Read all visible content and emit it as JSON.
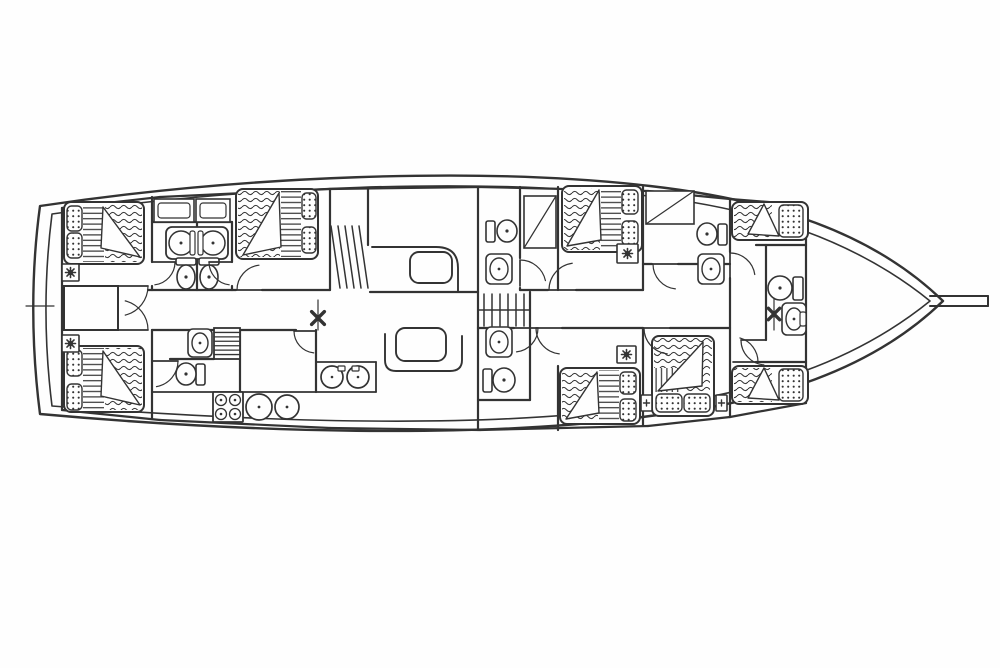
{
  "meta": {
    "type": "boat-deck-plan",
    "description": "Black-line accommodation / layout plan of a gulet style sailing yacht, bow to the right with bowsprit, six double-bed guest cabins, two bow crew berths, bathrooms with toilets and washbasins, central saloon with settees and tables, galley with stove and sinks, companionway stairs, two mast positions"
  },
  "canvas": {
    "width": 1000,
    "height": 668,
    "background": "#fefefe",
    "ink": "#333333"
  },
  "hull": {
    "outer": "M 40,206 C 240,176 480,166 650,186 C 772,200 872,232 943,301 C 872,370 772,402 650,416 C 480,440 240,432 40,414 C 31,344 31,272 40,206 Z",
    "inner": "M 52,214 C 246,186 480,177 648,196 C 762,209 856,241 930,301 C 856,361 762,393 648,406 C 480,431 246,421 52,406 C 44,342 44,277 52,214 Z",
    "bowsprit": [
      [
        930,
        296,
        988,
        296
      ],
      [
        930,
        306,
        988,
        306
      ],
      [
        988,
        296,
        988,
        306
      ]
    ],
    "stern_tick": [
      26,
      306,
      54,
      306
    ]
  },
  "walls": [
    [
      62,
      208,
      62,
      410
    ],
    [
      806,
      205,
      806,
      403
    ],
    [
      62,
      208,
      160,
      197
    ],
    [
      160,
      197,
      330,
      189
    ],
    [
      330,
      189,
      480,
      187
    ],
    [
      480,
      187,
      648,
      191
    ],
    [
      648,
      191,
      730,
      199
    ],
    [
      730,
      199,
      806,
      205
    ],
    [
      62,
      410,
      160,
      420
    ],
    [
      160,
      420,
      330,
      428
    ],
    [
      330,
      428,
      480,
      430
    ],
    [
      480,
      430,
      648,
      426
    ],
    [
      648,
      426,
      730,
      417
    ],
    [
      730,
      417,
      806,
      403
    ],
    [
      152,
      197,
      152,
      262
    ],
    [
      152,
      286,
      152,
      290
    ],
    [
      152,
      330,
      152,
      419
    ],
    [
      152,
      222,
      232,
      222
    ],
    [
      197,
      222,
      197,
      290
    ],
    [
      232,
      222,
      232,
      262
    ],
    [
      232,
      286,
      232,
      290
    ],
    [
      148,
      290,
      236,
      290
    ],
    [
      262,
      290,
      330,
      290
    ],
    [
      370,
      292,
      478,
      292
    ],
    [
      152,
      330,
      296,
      330
    ],
    [
      316,
      330,
      316,
      392
    ],
    [
      330,
      189,
      330,
      290
    ],
    [
      368,
      189,
      368,
      245
    ],
    [
      478,
      187,
      478,
      292
    ],
    [
      478,
      292,
      478,
      328
    ],
    [
      478,
      328,
      478,
      430
    ],
    [
      520,
      187,
      520,
      258
    ],
    [
      520,
      288,
      520,
      290
    ],
    [
      558,
      187,
      558,
      290
    ],
    [
      520,
      290,
      548,
      290
    ],
    [
      576,
      290,
      643,
      290
    ],
    [
      530,
      292,
      530,
      328
    ],
    [
      478,
      328,
      514,
      328
    ],
    [
      562,
      328,
      643,
      328
    ],
    [
      670,
      328,
      730,
      328
    ],
    [
      530,
      328,
      530,
      400
    ],
    [
      478,
      400,
      530,
      400
    ],
    [
      558,
      366,
      558,
      430
    ],
    [
      643,
      187,
      643,
      290
    ],
    [
      643,
      328,
      643,
      425
    ],
    [
      643,
      264,
      652,
      264
    ],
    [
      678,
      264,
      730,
      264
    ],
    [
      730,
      199,
      730,
      252
    ],
    [
      730,
      278,
      730,
      417
    ],
    [
      756,
      245,
      806,
      245
    ],
    [
      756,
      362,
      806,
      362
    ],
    [
      766,
      245,
      766,
      340
    ],
    [
      170,
      359,
      214,
      359
    ],
    [
      240,
      330,
      240,
      392
    ]
  ],
  "hatch": {
    "rect": [
      64,
      286,
      54,
      44
    ]
  },
  "galley_lines": [
    [
      152,
      392,
      316,
      392
    ],
    [
      316,
      362,
      376,
      362
    ],
    [
      376,
      362,
      376,
      392
    ],
    [
      316,
      392,
      376,
      392
    ]
  ],
  "stairs": [
    {
      "name": "stairs-forward",
      "lines": [
        [
          331,
          226,
          340,
          288
        ],
        [
          338,
          226,
          347,
          288
        ],
        [
          345,
          226,
          354,
          288
        ],
        [
          352,
          226,
          361,
          288
        ],
        [
          359,
          226,
          368,
          288
        ]
      ]
    },
    {
      "name": "companionway-steps",
      "lines": [
        [
          484,
          294,
          484,
          326
        ],
        [
          492,
          294,
          492,
          326
        ],
        [
          500,
          294,
          500,
          326
        ],
        [
          508,
          294,
          508,
          326
        ],
        [
          516,
          294,
          516,
          326
        ],
        [
          524,
          294,
          524,
          326
        ],
        [
          478,
          310,
          530,
          310
        ]
      ]
    }
  ],
  "ladder": {
    "rect": [
      214,
      328,
      26,
      31
    ],
    "rungs": 6
  },
  "settees": [
    "M 372,247 L 436,247 Q 458,247 458,268 L 458,292",
    "M 385,334 L 385,360 Q 385,371 396,371 L 450,371 Q 462,371 462,360 L 462,336"
  ],
  "tables": [
    [
      410,
      252,
      42,
      31
    ],
    [
      396,
      328,
      50,
      33
    ]
  ],
  "cabinets": [
    {
      "rect": [
        154,
        199,
        40,
        23
      ],
      "inner": [
        158,
        203,
        32,
        15
      ]
    },
    {
      "rect": [
        196,
        199,
        34,
        23
      ],
      "inner": [
        200,
        203,
        26,
        15
      ]
    },
    {
      "rect": [
        524,
        196,
        32,
        52
      ],
      "diag": [
        524,
        248,
        556,
        196
      ]
    },
    {
      "rect": [
        646,
        191,
        48,
        33
      ],
      "diag": [
        646,
        224,
        694,
        191
      ]
    }
  ],
  "beds": [
    {
      "outline": [
        64,
        202,
        80,
        62
      ],
      "waves": [
        [
          105,
          204,
          37,
          58
        ]
      ],
      "stripes": [
        [
          83,
          204,
          21,
          58,
          "h"
        ]
      ],
      "pillows": [
        [
          67,
          206,
          15,
          25
        ],
        [
          67,
          233,
          15,
          25
        ]
      ],
      "fold": [
        [
          103,
          207
        ],
        [
          140,
          257
        ],
        [
          101,
          248
        ]
      ]
    },
    {
      "outline": [
        64,
        346,
        80,
        66
      ],
      "waves": [
        [
          105,
          348,
          37,
          62
        ]
      ],
      "stripes": [
        [
          83,
          348,
          21,
          62,
          "h"
        ]
      ],
      "pillows": [
        [
          67,
          350,
          15,
          26
        ],
        [
          67,
          384,
          15,
          26
        ]
      ],
      "fold": [
        [
          103,
          351
        ],
        [
          140,
          405
        ],
        [
          101,
          396
        ]
      ]
    },
    {
      "outline": [
        236,
        189,
        82,
        70
      ],
      "waves": [
        [
          238,
          191,
          42,
          66
        ]
      ],
      "stripes": [
        [
          281,
          191,
          20,
          66,
          "h"
        ]
      ],
      "pillows": [
        [
          302,
          193,
          14,
          26
        ],
        [
          302,
          227,
          14,
          26
        ]
      ],
      "fold": [
        [
          279,
          193
        ],
        [
          243,
          255
        ],
        [
          281,
          247
        ]
      ]
    },
    {
      "outline": [
        562,
        186,
        80,
        66
      ],
      "waves": [
        [
          564,
          188,
          36,
          62
        ]
      ],
      "stripes": [
        [
          601,
          188,
          20,
          62,
          "h"
        ]
      ],
      "pillows": [
        [
          622,
          190,
          16,
          24
        ],
        [
          622,
          221,
          16,
          24
        ]
      ],
      "fold": [
        [
          599,
          190
        ],
        [
          567,
          246
        ],
        [
          601,
          240
        ]
      ]
    },
    {
      "outline": [
        560,
        368,
        80,
        56
      ],
      "waves": [
        [
          562,
          370,
          36,
          52
        ]
      ],
      "stripes": [
        [
          599,
          370,
          20,
          52,
          "h"
        ]
      ],
      "pillows": [
        [
          620,
          372,
          16,
          22
        ],
        [
          620,
          399,
          16,
          22
        ]
      ],
      "fold": [
        [
          597,
          372
        ],
        [
          566,
          419
        ],
        [
          599,
          413
        ]
      ]
    },
    {
      "outline": [
        652,
        336,
        62,
        80
      ],
      "waves": [
        [
          654,
          338,
          58,
          30
        ],
        [
          684,
          368,
          26,
          24
        ]
      ],
      "stripes": [
        [
          655,
          368,
          27,
          24,
          "v"
        ]
      ],
      "pillows": [
        [
          656,
          394,
          26,
          18
        ],
        [
          684,
          394,
          26,
          18
        ]
      ],
      "fold": [
        [
          703,
          342
        ],
        [
          658,
          391
        ],
        [
          702,
          386
        ]
      ]
    },
    {
      "outline": [
        732,
        202,
        76,
        38
      ],
      "waves": [
        [
          734,
          204,
          38,
          34
        ]
      ],
      "stripes": [],
      "pillows": [
        [
          779,
          205,
          24,
          32
        ]
      ],
      "fold": [
        [
          764,
          204
        ],
        [
          779,
          236
        ],
        [
          748,
          234
        ]
      ]
    },
    {
      "outline": [
        732,
        366,
        76,
        38
      ],
      "waves": [
        [
          734,
          368,
          38,
          34
        ]
      ],
      "stripes": [],
      "pillows": [
        [
          779,
          369,
          24,
          32
        ]
      ],
      "fold": [
        [
          764,
          368
        ],
        [
          779,
          400
        ],
        [
          748,
          398
        ]
      ]
    }
  ],
  "vanity": {
    "box": [
      166,
      227,
      62,
      32
    ],
    "bowls": [
      [
        181,
        243,
        12,
        12
      ],
      [
        213,
        243,
        12,
        12
      ]
    ],
    "dividers": [
      [
        190,
        231,
        5,
        24
      ],
      [
        198,
        231,
        5,
        24
      ]
    ]
  },
  "toilets": [
    {
      "tank": [
        176,
        258,
        20,
        7
      ],
      "bowl": [
        186,
        277,
        9,
        12
      ]
    },
    {
      "tank": [
        199,
        258,
        20,
        7
      ],
      "bowl": [
        209,
        277,
        9,
        12
      ]
    },
    {
      "tank": [
        486,
        221,
        9,
        21
      ],
      "bowl": [
        507,
        231,
        10,
        11
      ]
    },
    {
      "tank": [
        483,
        369,
        9,
        23
      ],
      "bowl": [
        504,
        380,
        11,
        12
      ]
    },
    {
      "tank": [
        196,
        364,
        9,
        21
      ],
      "bowl": [
        186,
        374,
        10,
        11
      ]
    },
    {
      "tank": [
        718,
        224,
        9,
        21
      ],
      "bowl": [
        707,
        234,
        10,
        11
      ]
    },
    {
      "tank": [
        793,
        277,
        10,
        23
      ],
      "bowl": [
        780,
        288,
        12,
        12
      ]
    }
  ],
  "sinks": [
    {
      "box": [
        188,
        329,
        24,
        28
      ],
      "bowl": [
        200,
        343,
        8,
        10
      ]
    },
    {
      "box": [
        486,
        254,
        26,
        30
      ],
      "bowl": [
        499,
        269,
        9,
        11
      ]
    },
    {
      "box": [
        486,
        327,
        26,
        30
      ],
      "bowl": [
        499,
        342,
        9,
        11
      ]
    },
    {
      "box": [
        698,
        254,
        26,
        30
      ],
      "bowl": [
        711,
        269,
        9,
        11
      ]
    },
    {
      "box": [
        782,
        303,
        24,
        32
      ],
      "bowl": [
        794,
        319,
        8,
        11
      ],
      "tap": [
        800,
        312,
        6,
        14
      ]
    }
  ],
  "corner_units": [
    {
      "box": [
        62,
        264,
        17,
        17
      ],
      "glyph": "fan"
    },
    {
      "box": [
        62,
        335,
        17,
        17
      ],
      "glyph": "fan"
    },
    {
      "box": [
        617,
        244,
        21,
        19
      ],
      "glyph": "fan"
    },
    {
      "box": [
        617,
        346,
        19,
        17
      ],
      "glyph": "fan"
    },
    {
      "box": [
        641,
        395,
        11,
        16
      ],
      "glyph": "plus"
    },
    {
      "box": [
        716,
        395,
        11,
        16
      ],
      "glyph": "plus"
    }
  ],
  "stove": {
    "rect": [
      213,
      392,
      30,
      30
    ],
    "burners": [
      [
        221,
        400
      ],
      [
        235,
        400
      ],
      [
        221,
        414
      ],
      [
        235,
        414
      ]
    ],
    "burner_r": 5.5
  },
  "pots": [
    [
      259,
      407,
      13
    ],
    [
      287,
      407,
      12
    ]
  ],
  "island": {
    "circles": [
      [
        332,
        377,
        11
      ],
      [
        358,
        377,
        11
      ]
    ],
    "taps": [
      [
        338,
        366,
        7,
        5
      ],
      [
        352,
        366,
        7,
        5
      ]
    ]
  },
  "doors": [
    {
      "h": [
        118,
        286
      ],
      "r": 30,
      "a0": 0,
      "a1": 76
    },
    {
      "h": [
        118,
        330
      ],
      "r": 30,
      "a0": 0,
      "a1": -76
    },
    {
      "h": [
        152,
        262
      ],
      "r": 23,
      "a0": 0,
      "a1": 83
    },
    {
      "h": [
        232,
        262
      ],
      "r": 23,
      "a0": 180,
      "a1": 97
    },
    {
      "h": [
        262,
        290
      ],
      "r": 25,
      "a0": 180,
      "a1": 263
    },
    {
      "h": [
        316,
        331
      ],
      "r": 22,
      "a0": 180,
      "a1": 96
    },
    {
      "h": [
        152,
        361
      ],
      "r": 26,
      "a0": 0,
      "a1": 80
    },
    {
      "h": [
        520,
        286
      ],
      "r": 26,
      "a0": 270,
      "a1": 348
    },
    {
      "h": [
        576,
        290
      ],
      "r": 27,
      "a0": 180,
      "a1": 262
    },
    {
      "h": [
        514,
        328
      ],
      "r": 24,
      "a0": 0,
      "a1": 84
    },
    {
      "h": [
        562,
        328
      ],
      "r": 26,
      "a0": 180,
      "a1": 96
    },
    {
      "h": [
        670,
        328
      ],
      "r": 26,
      "a0": 180,
      "a1": 96
    },
    {
      "h": [
        678,
        264
      ],
      "r": 25,
      "a0": 180,
      "a1": 96
    },
    {
      "h": [
        730,
        278
      ],
      "r": 25,
      "a0": 270,
      "a1": 352
    },
    {
      "h": [
        766,
        340
      ],
      "r": 25,
      "a0": 180,
      "a1": 95
    },
    {
      "h": [
        733,
        362
      ],
      "r": 25,
      "a0": 0,
      "a1": -74
    }
  ],
  "masts": [
    {
      "c": [
        318,
        318
      ],
      "axis": [
        318,
        300,
        318,
        330
      ],
      "arm": 9
    },
    {
      "c": [
        774,
        314
      ],
      "axis": [
        774,
        298,
        774,
        330
      ],
      "arm": 8
    }
  ]
}
